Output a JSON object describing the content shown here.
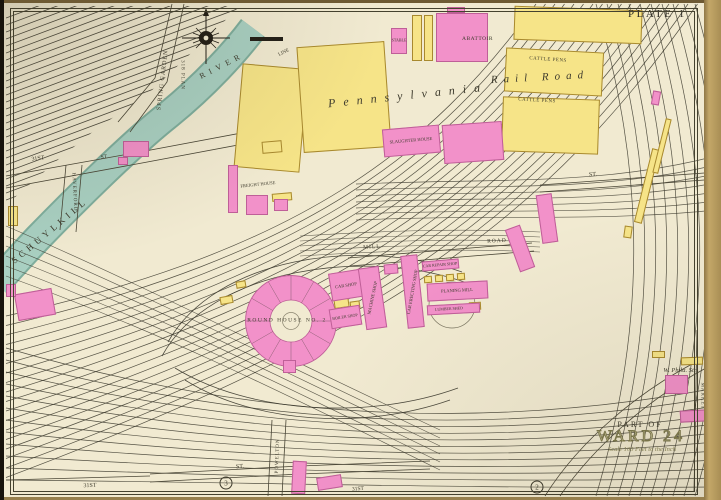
{
  "frame": {
    "plate_title": "PLATE 1"
  },
  "cartouche": {
    "part_of": "PART OF",
    "ward": "WARD 24",
    "scale": "Scale 100 Feet to the Inch"
  },
  "water": {
    "name1": "SCHUYLKILL",
    "name2": "RIVER",
    "line": "LINE"
  },
  "railroad": {
    "name1": "Pennsylvania",
    "name2": "Rail Road"
  },
  "streets": [
    {
      "text": "SPRING GARDEN"
    },
    {
      "text": "318 PLAN"
    },
    {
      "text": "31ST"
    },
    {
      "text": "ST"
    },
    {
      "text": "HAVERFORD"
    },
    {
      "text": "31ST"
    },
    {
      "text": "ST."
    },
    {
      "text": "31ST"
    },
    {
      "text": "POWELTON"
    },
    {
      "text": "MILL"
    },
    {
      "text": "ROAD"
    },
    {
      "text": "ST."
    },
    {
      "text": "MARKET"
    }
  ],
  "buildings": [
    {
      "label": "STABLE"
    },
    {
      "label": "ABATTOIR"
    },
    {
      "label": "CATTLE PENS"
    },
    {
      "label": "CATTLE PENS"
    },
    {
      "label": "SLAUGHTER HOUSE"
    },
    {
      "label": "FREIGHT HOUSE"
    },
    {
      "label": "ROUND HOUSE NO. 2"
    },
    {
      "label": "CAR SHOP"
    },
    {
      "label": "MACHINE SHOP"
    },
    {
      "label": "CAR ERECTING SHOP"
    },
    {
      "label": "CAR REPAIR SHOP"
    },
    {
      "label": "PLANING MILL"
    },
    {
      "label": "LUMBER SHED"
    },
    {
      "label": "BOILER SHOP"
    },
    {
      "label": "W. Phila. Stn."
    }
  ],
  "markers": {
    "circle3": "3",
    "circle2": "2"
  },
  "colors": {
    "paper": "#f1ead1",
    "page_edge": "#b3985f",
    "river": "#a9d0c2",
    "river_edge": "#7fae9d",
    "brick": "#f291c9",
    "brick_border": "#bf5f98",
    "wood": "#f6e488",
    "wood_border": "#a8892f",
    "track": "#3a372c"
  }
}
